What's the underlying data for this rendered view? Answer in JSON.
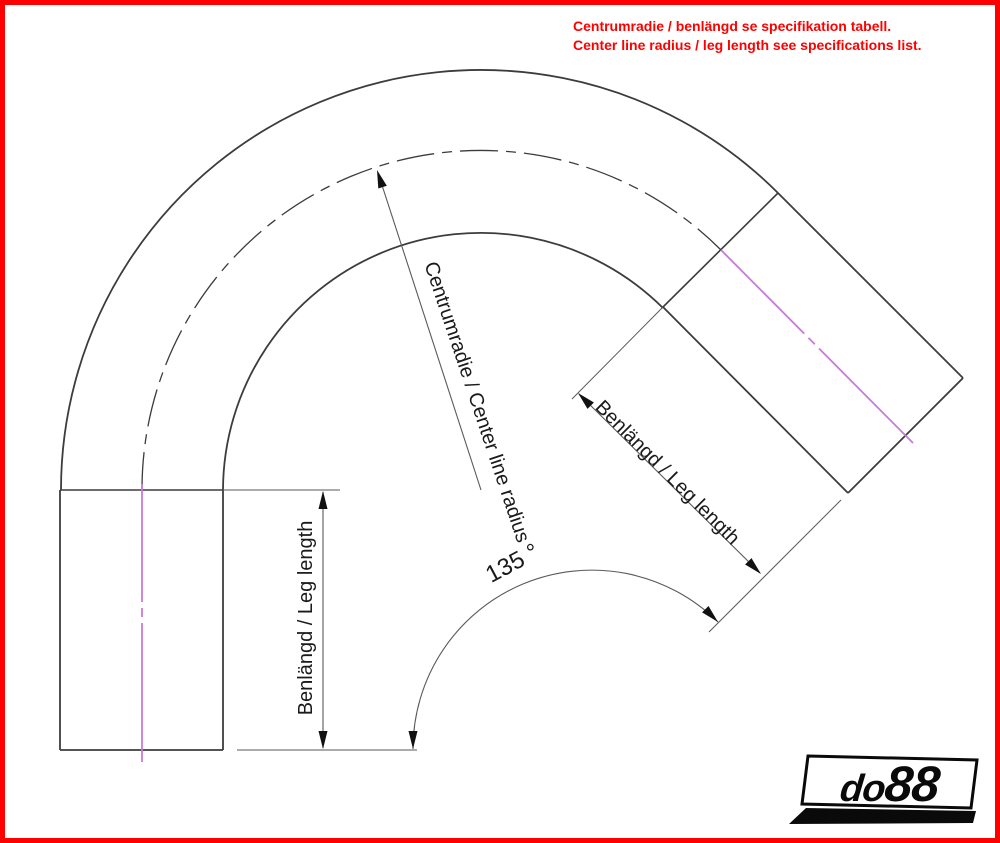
{
  "note": {
    "line1": "Centrumradie / benlängd se specifikation tabell.",
    "line2": "Center line radius / leg length see specifications list."
  },
  "dimensions": {
    "left_leg_label": "Benlängd / Leg length",
    "right_leg_label": "Benlängd / Leg length",
    "radius_label": "Centrumradie / Center line radius",
    "angle_label": "135 °"
  },
  "logo": {
    "prefix": "do",
    "suffix": "88"
  },
  "colors": {
    "border": "#FF0000",
    "note_text": "#FF0000",
    "drawing_line": "#3C3C3C",
    "dimension_line": "#5A5A5A",
    "centerline_magenta": "#C87BD8",
    "logo_black": "#0A0A0A"
  }
}
